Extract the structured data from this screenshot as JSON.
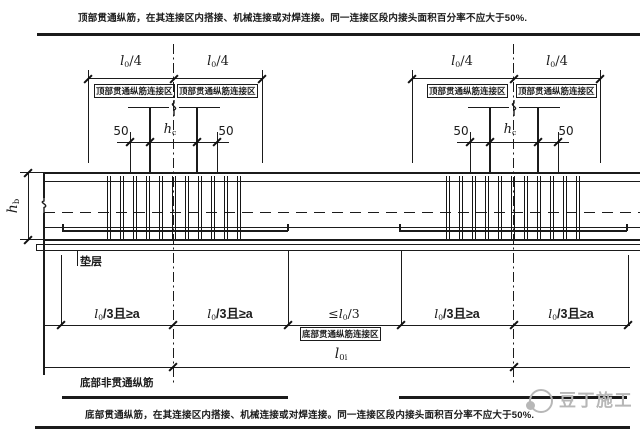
{
  "drawing": {
    "top_note": "顶部贯通纵筋，在其连接区内搭接、机械连接或对焊连接。同一连接区段内接头面积百分率不应大于50%.",
    "bottom_note": "底部贯通纵筋，在其连接区内搭接、机械连接或对焊连接。同一连接区段内接头面积百分率不应大于50%.",
    "top_zone_label": "顶部贯通纵筋连接区",
    "bottom_zone_label": "底部贯通纵筋连接区",
    "bottom_nonthrough_label": "底部非贯通纵筋",
    "bedding_label": "垫层",
    "dims": {
      "quarter_span": {
        "base": "l",
        "sub": "0",
        "suffix": "/4"
      },
      "col_side_offset": "50",
      "col_width": {
        "base": "h",
        "sub": "c"
      },
      "beam_height": {
        "base": "h",
        "sub": "b"
      },
      "third_span_min_a": {
        "base": "l",
        "sub": "0",
        "suffix": "/3且≥a"
      },
      "third_span_max": {
        "prefix": "≤",
        "base": "l",
        "sub": "0",
        "suffix": "/3"
      },
      "span_length": {
        "base": "l",
        "sub": "0i"
      }
    }
  },
  "watermark": {
    "text": "豆丁施工"
  },
  "colors": {
    "line": "#1b1b1b",
    "watermark": "#b7b7b7",
    "background": "#ffffff"
  }
}
